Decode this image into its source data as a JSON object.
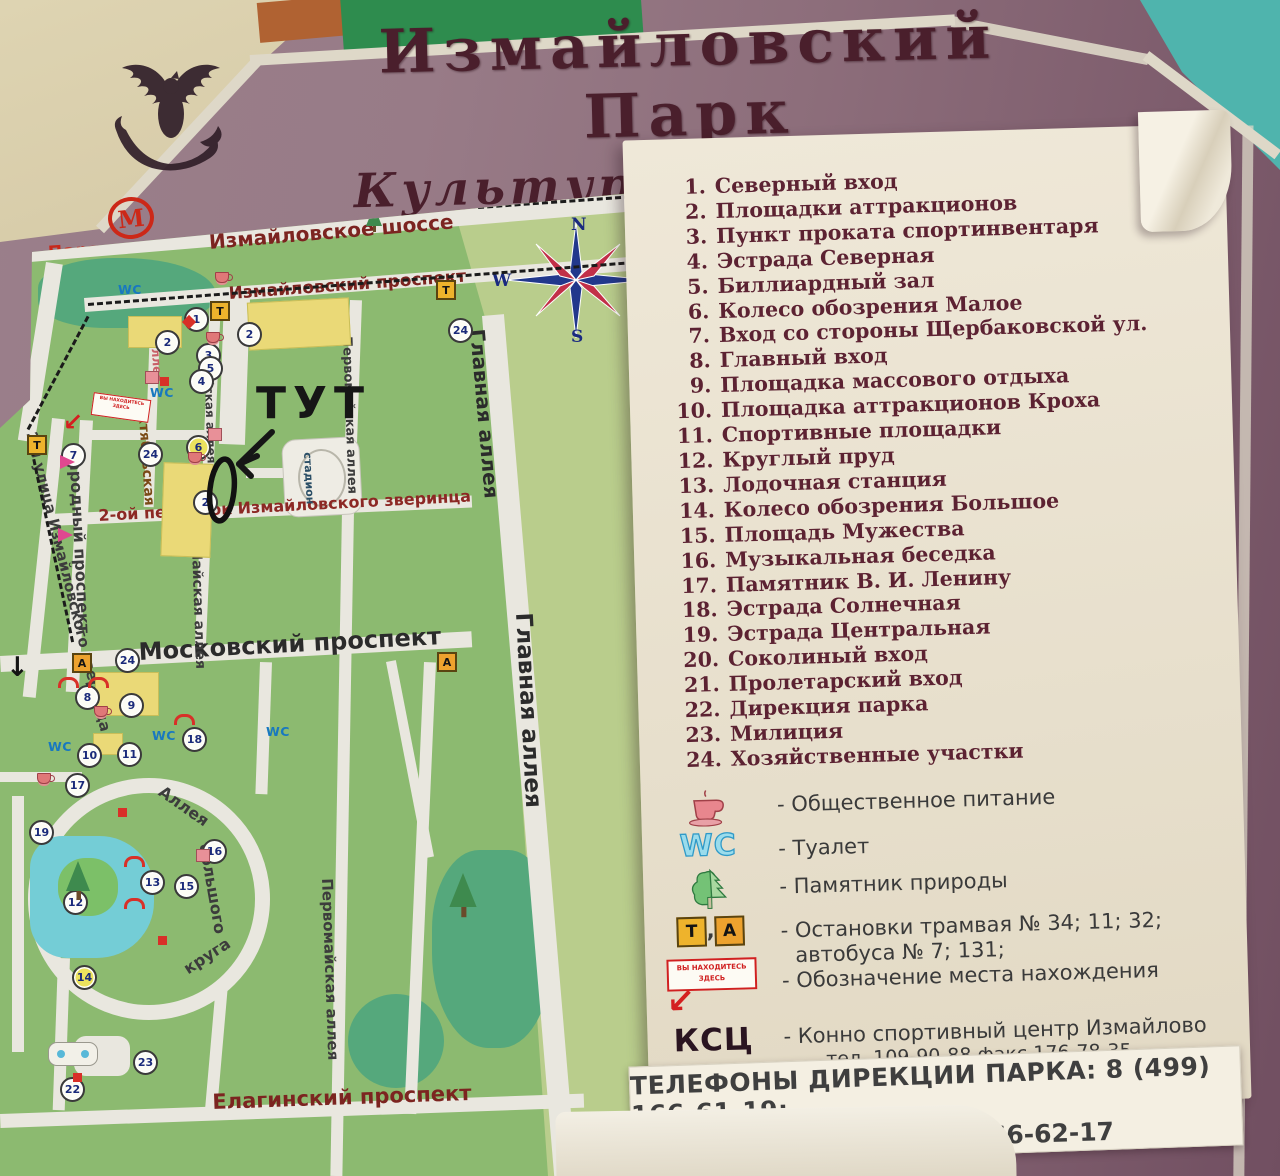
{
  "title": {
    "line1": "Измайловский Парк",
    "line2": "Культуры и Отдыха"
  },
  "metro": {
    "symbol": "М",
    "station": "Партизанская"
  },
  "compass": {
    "n": "N",
    "e": "E",
    "s": "S",
    "w": "W"
  },
  "annotation": {
    "text": "ТУТ"
  },
  "here_sign": {
    "line1": "ВЫ НАХОДИТЕСЬ",
    "line2": "ЗДЕСЬ"
  },
  "legend": {
    "items": [
      {
        "num": "1.",
        "label": "Северный вход"
      },
      {
        "num": "2.",
        "label": "Площадки аттракционов"
      },
      {
        "num": "3.",
        "label": "Пункт проката спортинвентаря"
      },
      {
        "num": "4.",
        "label": "Эстрада Северная"
      },
      {
        "num": "5.",
        "label": "Биллиардный зал"
      },
      {
        "num": "6.",
        "label": "Колесо обозрения Малое"
      },
      {
        "num": "7.",
        "label": "Вход со стороны Щербаковской ул."
      },
      {
        "num": "8.",
        "label": "Главный вход"
      },
      {
        "num": "9.",
        "label": "Площадка массового отдыха"
      },
      {
        "num": "10.",
        "label": "Площадка аттракционов Кроха"
      },
      {
        "num": "11.",
        "label": "Спортивные площадки"
      },
      {
        "num": "12.",
        "label": "Круглый пруд"
      },
      {
        "num": "13.",
        "label": "Лодочная станция"
      },
      {
        "num": "14.",
        "label": "Колесо обозрения Большое"
      },
      {
        "num": "15.",
        "label": "Площадь Мужества"
      },
      {
        "num": "16.",
        "label": "Музыкальная беседка"
      },
      {
        "num": "17.",
        "label": "Памятник В. И. Ленину"
      },
      {
        "num": "18.",
        "label": "Эстрада Солнечная"
      },
      {
        "num": "19.",
        "label": "Эстрада Центральная"
      },
      {
        "num": "20.",
        "label": "Соколиный вход"
      },
      {
        "num": "21.",
        "label": "Пролетарский вход"
      },
      {
        "num": "22.",
        "label": "Дирекция парка"
      },
      {
        "num": "23.",
        "label": "Милиция"
      },
      {
        "num": "24.",
        "label": "Хозяйственные участки"
      }
    ],
    "icons": [
      {
        "type": "cup",
        "label": "- Общественное питание"
      },
      {
        "type": "wc",
        "symbol": "WC",
        "label": "- Туалет"
      },
      {
        "type": "tree",
        "label": "- Памятник природы"
      },
      {
        "type": "tram",
        "symbol1": "Т",
        "symbol2": "А",
        "comma": ",",
        "label": "- Остановки трамвая № 34; 11; 32;",
        "label2": "автобуса № 7; 131;"
      },
      {
        "type": "here",
        "label": "- Обозначение места нахождения",
        "arrow": "↙"
      },
      {
        "type": "ksc",
        "symbol": "КСЦ",
        "label": "- Конно спортивный центр Измайлово",
        "label2": "тел. 109-90-88 факс 176-78-35"
      }
    ]
  },
  "phones": {
    "line1": "ТЕЛЕФОНЫ ДИРЕКЦИИ ПАРКА: 8 (499) 166-61-19;",
    "line2": "ФАКС:  8 (499) 166-62-17"
  },
  "colors": {
    "board": "#8d6e7b",
    "title_text": "#4a1f2c",
    "legend_text": "#5c2232",
    "park_green": "#8cba70",
    "park_light_green": "#b9cd8c",
    "park_dark_green": "#55a87c",
    "pond_blue": "#74cdd6",
    "road": "#e9e7df",
    "accent_red": "#d02020",
    "metro_red": "#cc2818"
  },
  "map_data": {
    "streets": [
      {
        "t": "Измайловское шоссе",
        "x": 208,
        "y": 230,
        "r": -4.8,
        "fs": 20,
        "cls": "st-red"
      },
      {
        "t": "Измайловский проспект",
        "x": 228,
        "y": 284,
        "r": -4.2,
        "fs": 17,
        "cls": "st-red"
      },
      {
        "t": "Московский проспект",
        "x": 138,
        "y": 638,
        "r": -3,
        "fs": 24,
        "cls": "st-dark"
      },
      {
        "t": "Елагинский проспект",
        "x": 212,
        "y": 1090,
        "r": -2,
        "fs": 21,
        "cls": "st-red"
      },
      {
        "t": "2-ой переулок Измайловского зверинца",
        "x": 98,
        "y": 506,
        "r": -3,
        "fs": 16,
        "cls": "st-red2"
      },
      {
        "t": "Главная аллея",
        "x": 489,
        "y": 328,
        "r": 85,
        "fs": 20,
        "cls": "st-dark"
      },
      {
        "t": "Главная аллея",
        "x": 536,
        "y": 612,
        "r": 87,
        "fs": 23,
        "cls": "st-dark"
      },
      {
        "t": "Первомайская аллея",
        "x": 354,
        "y": 336,
        "r": 88,
        "fs": 13,
        "cls": "st-dark2"
      },
      {
        "t": "Первомайская аллея",
        "x": 336,
        "y": 878,
        "r": 88,
        "fs": 15,
        "cls": "st-dark2"
      },
      {
        "t": "Майская аллея",
        "x": 215,
        "y": 358,
        "r": 88,
        "fs": 12,
        "cls": "st-dark2"
      },
      {
        "t": "Майская аллея",
        "x": 204,
        "y": 546,
        "r": 88,
        "fs": 14,
        "cls": "st-dark2"
      },
      {
        "t": "Народный проспект",
        "x": 84,
        "y": 446,
        "r": 87,
        "fs": 16,
        "cls": "st-dark2"
      },
      {
        "t": "2-я улица Измайловского зверинца",
        "x": 40,
        "y": 430,
        "r": 76,
        "fs": 15,
        "cls": "st-dark2"
      },
      {
        "t": "Октябрьская",
        "x": 150,
        "y": 402,
        "r": 86,
        "fs": 14,
        "cls": "st-brown"
      },
      {
        "t": "аллея",
        "x": 162,
        "y": 340,
        "r": 86,
        "fs": 12,
        "cls": "st-pink"
      },
      {
        "t": "Аллея",
        "x": 166,
        "y": 782,
        "r": 35,
        "fs": 16,
        "cls": "st-dark2"
      },
      {
        "t": "большого",
        "x": 214,
        "y": 842,
        "r": 80,
        "fs": 16,
        "cls": "st-dark2"
      },
      {
        "t": "круга",
        "x": 180,
        "y": 962,
        "r": -33,
        "fs": 16,
        "cls": "st-dark2"
      },
      {
        "t": "стадион",
        "x": 314,
        "y": 452,
        "r": 87,
        "fs": 11,
        "cls": "st-blue"
      }
    ],
    "markers": [
      {
        "m": "yblock",
        "x": 128,
        "y": 316,
        "w": 52,
        "h": 30
      },
      {
        "m": "yblock",
        "x": 248,
        "y": 300,
        "w": 100,
        "h": 46,
        "r": -3
      },
      {
        "m": "yblock",
        "x": 162,
        "y": 463,
        "w": 48,
        "h": 92,
        "r": 2
      },
      {
        "m": "yblock",
        "x": 95,
        "y": 672,
        "w": 62,
        "h": 42
      },
      {
        "m": "yblock",
        "x": 93,
        "y": 733,
        "w": 28,
        "h": 20
      },
      {
        "m": "dash",
        "x": 88,
        "y": 303,
        "w": 556,
        "r": -4.4
      },
      {
        "m": "dash",
        "x": 28,
        "y": 428,
        "w": 128,
        "r": -62
      },
      {
        "m": "dash",
        "x": 30,
        "y": 440,
        "w": 205,
        "r": 78
      },
      {
        "m": "dash",
        "x": 478,
        "y": 206,
        "w": 180,
        "r": -4
      },
      {
        "m": "num",
        "t": "1",
        "x": 184,
        "y": 307
      },
      {
        "m": "num",
        "t": "2",
        "x": 155,
        "y": 330
      },
      {
        "m": "num",
        "t": "2",
        "x": 237,
        "y": 322
      },
      {
        "m": "num",
        "t": "24",
        "x": 448,
        "y": 318
      },
      {
        "m": "num",
        "t": "3",
        "x": 196,
        "y": 343
      },
      {
        "m": "num",
        "t": "5",
        "x": 198,
        "y": 356
      },
      {
        "m": "num",
        "t": "4",
        "x": 189,
        "y": 369
      },
      {
        "m": "num",
        "t": "6",
        "x": 186,
        "y": 435,
        "c": "yel"
      },
      {
        "m": "num",
        "t": "24",
        "x": 138,
        "y": 442
      },
      {
        "m": "num",
        "t": "2",
        "x": 193,
        "y": 490
      },
      {
        "m": "num",
        "t": "7",
        "x": 61,
        "y": 443
      },
      {
        "m": "num",
        "t": "24",
        "x": 115,
        "y": 648
      },
      {
        "m": "num",
        "t": "8",
        "x": 75,
        "y": 685
      },
      {
        "m": "num",
        "t": "9",
        "x": 119,
        "y": 693
      },
      {
        "m": "num",
        "t": "10",
        "x": 77,
        "y": 743
      },
      {
        "m": "num",
        "t": "11",
        "x": 117,
        "y": 742
      },
      {
        "m": "num",
        "t": "18",
        "x": 182,
        "y": 727
      },
      {
        "m": "num",
        "t": "17",
        "x": 65,
        "y": 773
      },
      {
        "m": "num",
        "t": "19",
        "x": 29,
        "y": 820
      },
      {
        "m": "num",
        "t": "12",
        "x": 63,
        "y": 890
      },
      {
        "m": "num",
        "t": "13",
        "x": 140,
        "y": 870
      },
      {
        "m": "num",
        "t": "15",
        "x": 174,
        "y": 874
      },
      {
        "m": "num",
        "t": "16",
        "x": 202,
        "y": 839
      },
      {
        "m": "num",
        "t": "14",
        "x": 72,
        "y": 965,
        "c": "yel"
      },
      {
        "m": "num",
        "t": "23",
        "x": 133,
        "y": 1050
      },
      {
        "m": "num",
        "t": "22",
        "x": 60,
        "y": 1077
      },
      {
        "m": "t",
        "t": "Т",
        "x": 210,
        "y": 301
      },
      {
        "m": "t",
        "t": "Т",
        "x": 436,
        "y": 280
      },
      {
        "m": "t",
        "t": "Т",
        "x": 27,
        "y": 435
      },
      {
        "m": "a",
        "t": "А",
        "x": 72,
        "y": 653
      },
      {
        "m": "a",
        "t": "А",
        "x": 437,
        "y": 652
      },
      {
        "m": "wc",
        "t": "WC",
        "x": 118,
        "y": 282
      },
      {
        "m": "wc",
        "t": "WC",
        "x": 150,
        "y": 385
      },
      {
        "m": "wc",
        "t": "WC",
        "x": 48,
        "y": 739
      },
      {
        "m": "wc",
        "t": "WC",
        "x": 152,
        "y": 728
      },
      {
        "m": "wc",
        "t": "WC",
        "x": 266,
        "y": 724
      },
      {
        "m": "cup",
        "x": 215,
        "y": 272
      },
      {
        "m": "cup",
        "x": 206,
        "y": 332
      },
      {
        "m": "cup",
        "x": 188,
        "y": 452
      },
      {
        "m": "cup",
        "x": 94,
        "y": 706
      },
      {
        "m": "cup",
        "x": 37,
        "y": 773
      },
      {
        "m": "dia",
        "x": 184,
        "y": 317
      },
      {
        "m": "red",
        "x": 160,
        "y": 377
      },
      {
        "m": "red",
        "x": 158,
        "y": 936
      },
      {
        "m": "red",
        "x": 73,
        "y": 1073
      },
      {
        "m": "red",
        "x": 118,
        "y": 808
      },
      {
        "m": "arc",
        "x": 58,
        "y": 677
      },
      {
        "m": "arc",
        "x": 88,
        "y": 677
      },
      {
        "m": "arc",
        "x": 174,
        "y": 714
      },
      {
        "m": "arc",
        "x": 124,
        "y": 856
      },
      {
        "m": "arc",
        "x": 124,
        "y": 898
      },
      {
        "m": "bldg",
        "x": 145,
        "y": 371
      },
      {
        "m": "bldg",
        "x": 208,
        "y": 428
      },
      {
        "m": "bldg",
        "x": 196,
        "y": 849
      },
      {
        "m": "parrow",
        "x": 58,
        "y": 528
      },
      {
        "m": "parrow",
        "x": 60,
        "y": 455
      },
      {
        "m": "herebox",
        "x": 92,
        "y": 396,
        "r": 8
      },
      {
        "m": "redarrow",
        "x": 63,
        "y": 408
      },
      {
        "m": "bdown",
        "x": 6,
        "y": 652
      },
      {
        "m": "tree",
        "x": 70,
        "y": 866,
        "s": 1.5
      },
      {
        "m": "tree",
        "x": 455,
        "y": 880,
        "s": 1.7
      },
      {
        "m": "tree",
        "x": 366,
        "y": 206,
        "s": 1.0
      },
      {
        "m": "b22",
        "x": 48,
        "y": 1042
      }
    ]
  }
}
